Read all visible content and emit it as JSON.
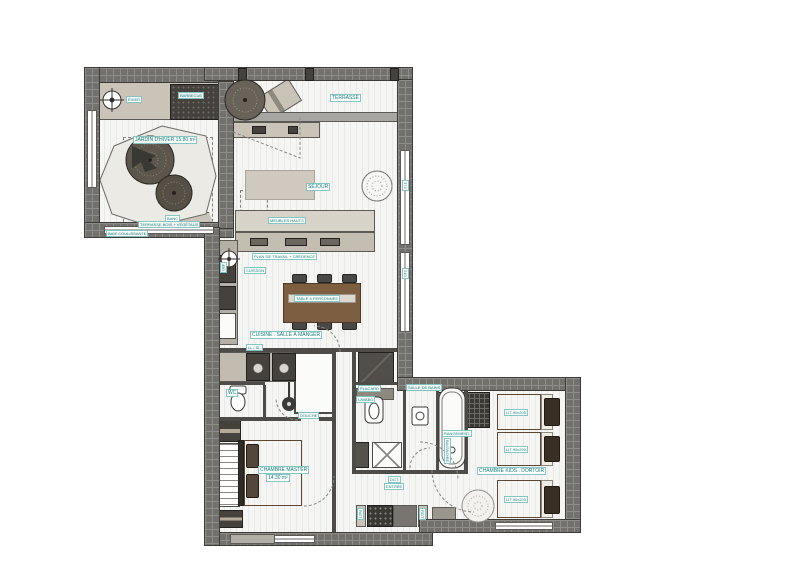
{
  "meta": {
    "drawing_type": "apartment floor plan",
    "style": "architectural plan, top view"
  },
  "colors": {
    "wall": "#73716d",
    "floor": "#f5f5f3",
    "accent_teal": "#13827f",
    "wood_table": "#7d5e40",
    "duvet_brown": "#9a7a5a",
    "beige_furniture": "#cac4b8",
    "dark_fixture": "#45423e"
  },
  "labels": {
    "winter_garden": "JARDIN D'HIVER 15.80 m²",
    "winter_sub": "TERRASSE BOIS + VÉGÉTAUX",
    "barbecue": "BARBECUE",
    "evier": "ÉVIER",
    "bench": "BANC",
    "baie_a": "BAIE COULISSANTE",
    "terrasse": "TERRASSE",
    "sejour": "SÉJOUR",
    "meuble_haut": "MEUBLES HAUTS",
    "plan_travail": "PLAN DE TRAVAIL + CRÉDENCE",
    "cuisson": "CUISSON",
    "table": "TABLE 8 PERSONNES",
    "cuisine": "CUISINE . SALLE À MANGER",
    "lave_linge": "LL / SL",
    "wc1": "WC",
    "douche": "DOUCHE",
    "placard": "PLACARD",
    "lavabo": "LAVABO",
    "salle_de_bains": "SALLE DE BAINS",
    "baignoire": "BAIGNOIRE",
    "rangement": "RANGEMENT",
    "master": "CHAMBRE MASTER",
    "master_area": "14.30 m²",
    "kids": "CHAMBRE KIDS . DORTOIR",
    "lit1": "LIT 90x200",
    "lit2": "LIT 90x200",
    "lit3": "LIT 90x200",
    "dgt1": "DGT.",
    "dgt2": "ENTRÉE",
    "rgt_l": "RGT",
    "rgt_r": "RGT",
    "dim_r1": "372",
    "dim_r2": "240",
    "dim_left": "450"
  }
}
